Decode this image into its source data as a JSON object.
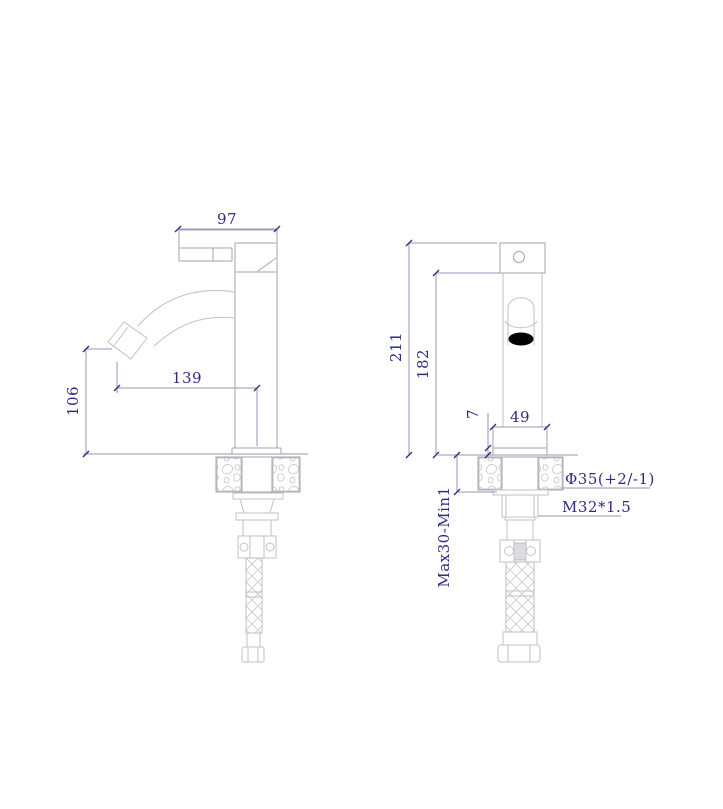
{
  "drawing": {
    "type": "technical-drawing",
    "subject": "single-handle basin faucet, side and front orthographic views with dimensions",
    "units": "mm",
    "colors": {
      "annotation_text": "#2d2d88",
      "dimension_line": "#9595b4",
      "object_line": "#a4a4ac",
      "light_line": "#c2c2c8",
      "outlet_fill": "#000000",
      "background": "#ffffff"
    },
    "dimensions": {
      "handle_width": "97",
      "spout_reach": "139",
      "spout_height": "106",
      "overall_height": "211",
      "body_height": "182",
      "deck_plate_height": "7",
      "base_width": "49",
      "mount_nut_diameter": "Φ35(+2/-1)",
      "thread_spec": "M32*1.5",
      "deck_clamp_range": "Max30-Min1"
    }
  }
}
